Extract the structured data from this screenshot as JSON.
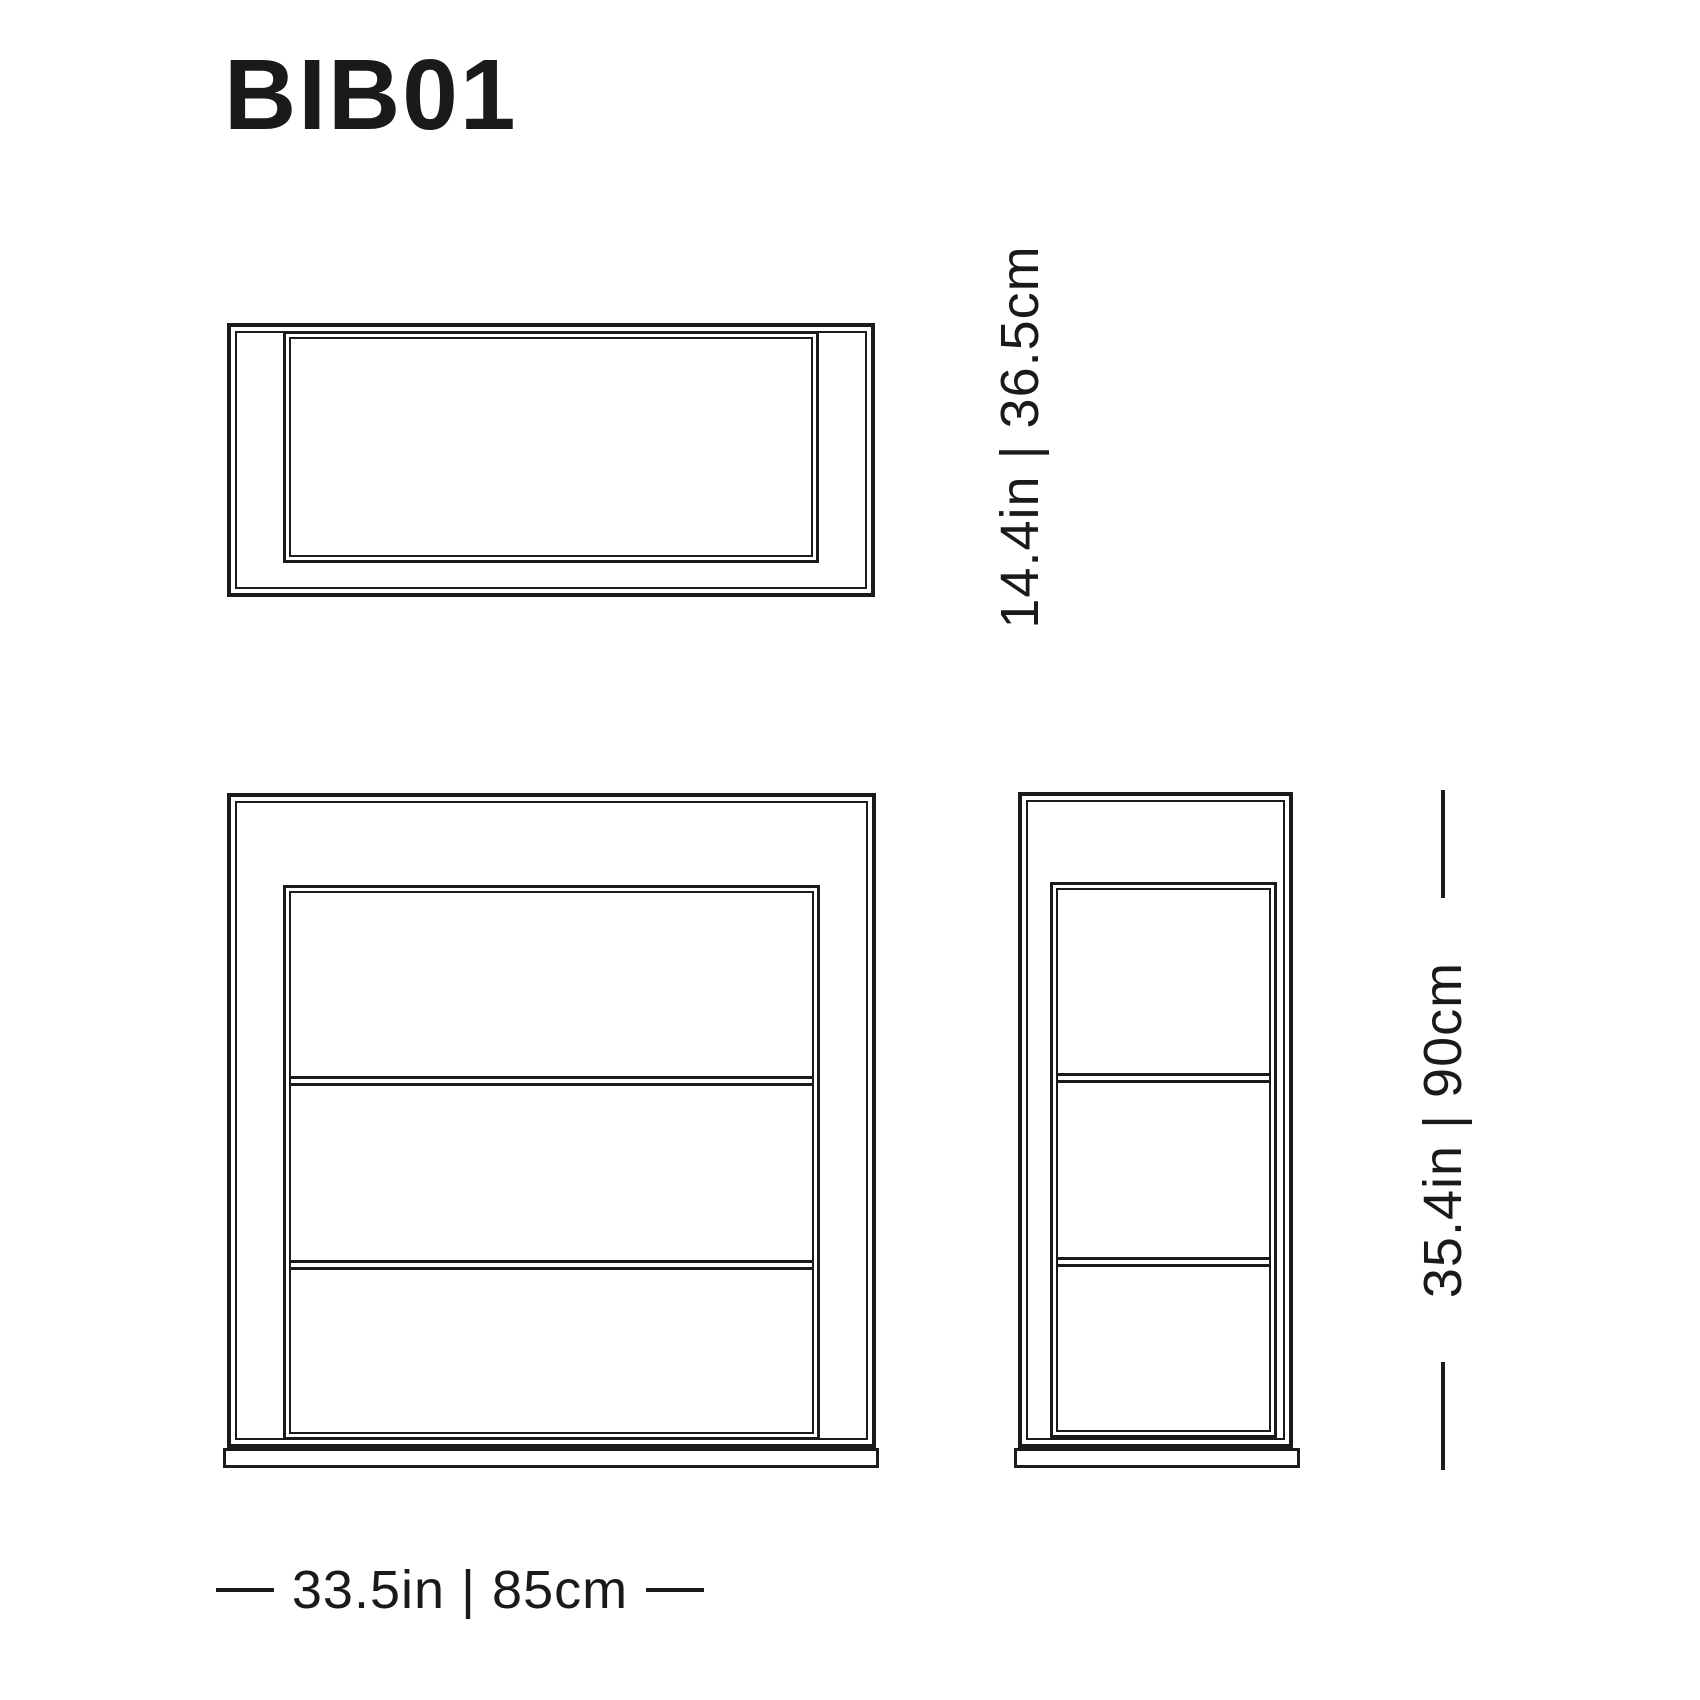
{
  "title": "BIB01",
  "colors": {
    "line": "#1b1b1b",
    "text": "#1a1a1a",
    "background": "#ffffff"
  },
  "dimensions": {
    "depth": {
      "label": "14.4in | 36.5cm",
      "inches": 14.4,
      "cm": 36.5,
      "orientation": "vertical",
      "applies_to": "top-view"
    },
    "height": {
      "label": "35.4in | 90cm",
      "inches": 35.4,
      "cm": 90,
      "orientation": "vertical",
      "applies_to": "side-view"
    },
    "width": {
      "label": "33.5in | 85cm",
      "inches": 33.5,
      "cm": 85,
      "orientation": "horizontal",
      "applies_to": "front-view"
    }
  },
  "views": {
    "top": {
      "name": "top view (plan)",
      "shelves": 0,
      "compartments": 1
    },
    "front": {
      "name": "front view",
      "shelves": 2,
      "compartments": 3
    },
    "side": {
      "name": "side view (profile)",
      "shelves": 2,
      "compartments": 3
    }
  }
}
